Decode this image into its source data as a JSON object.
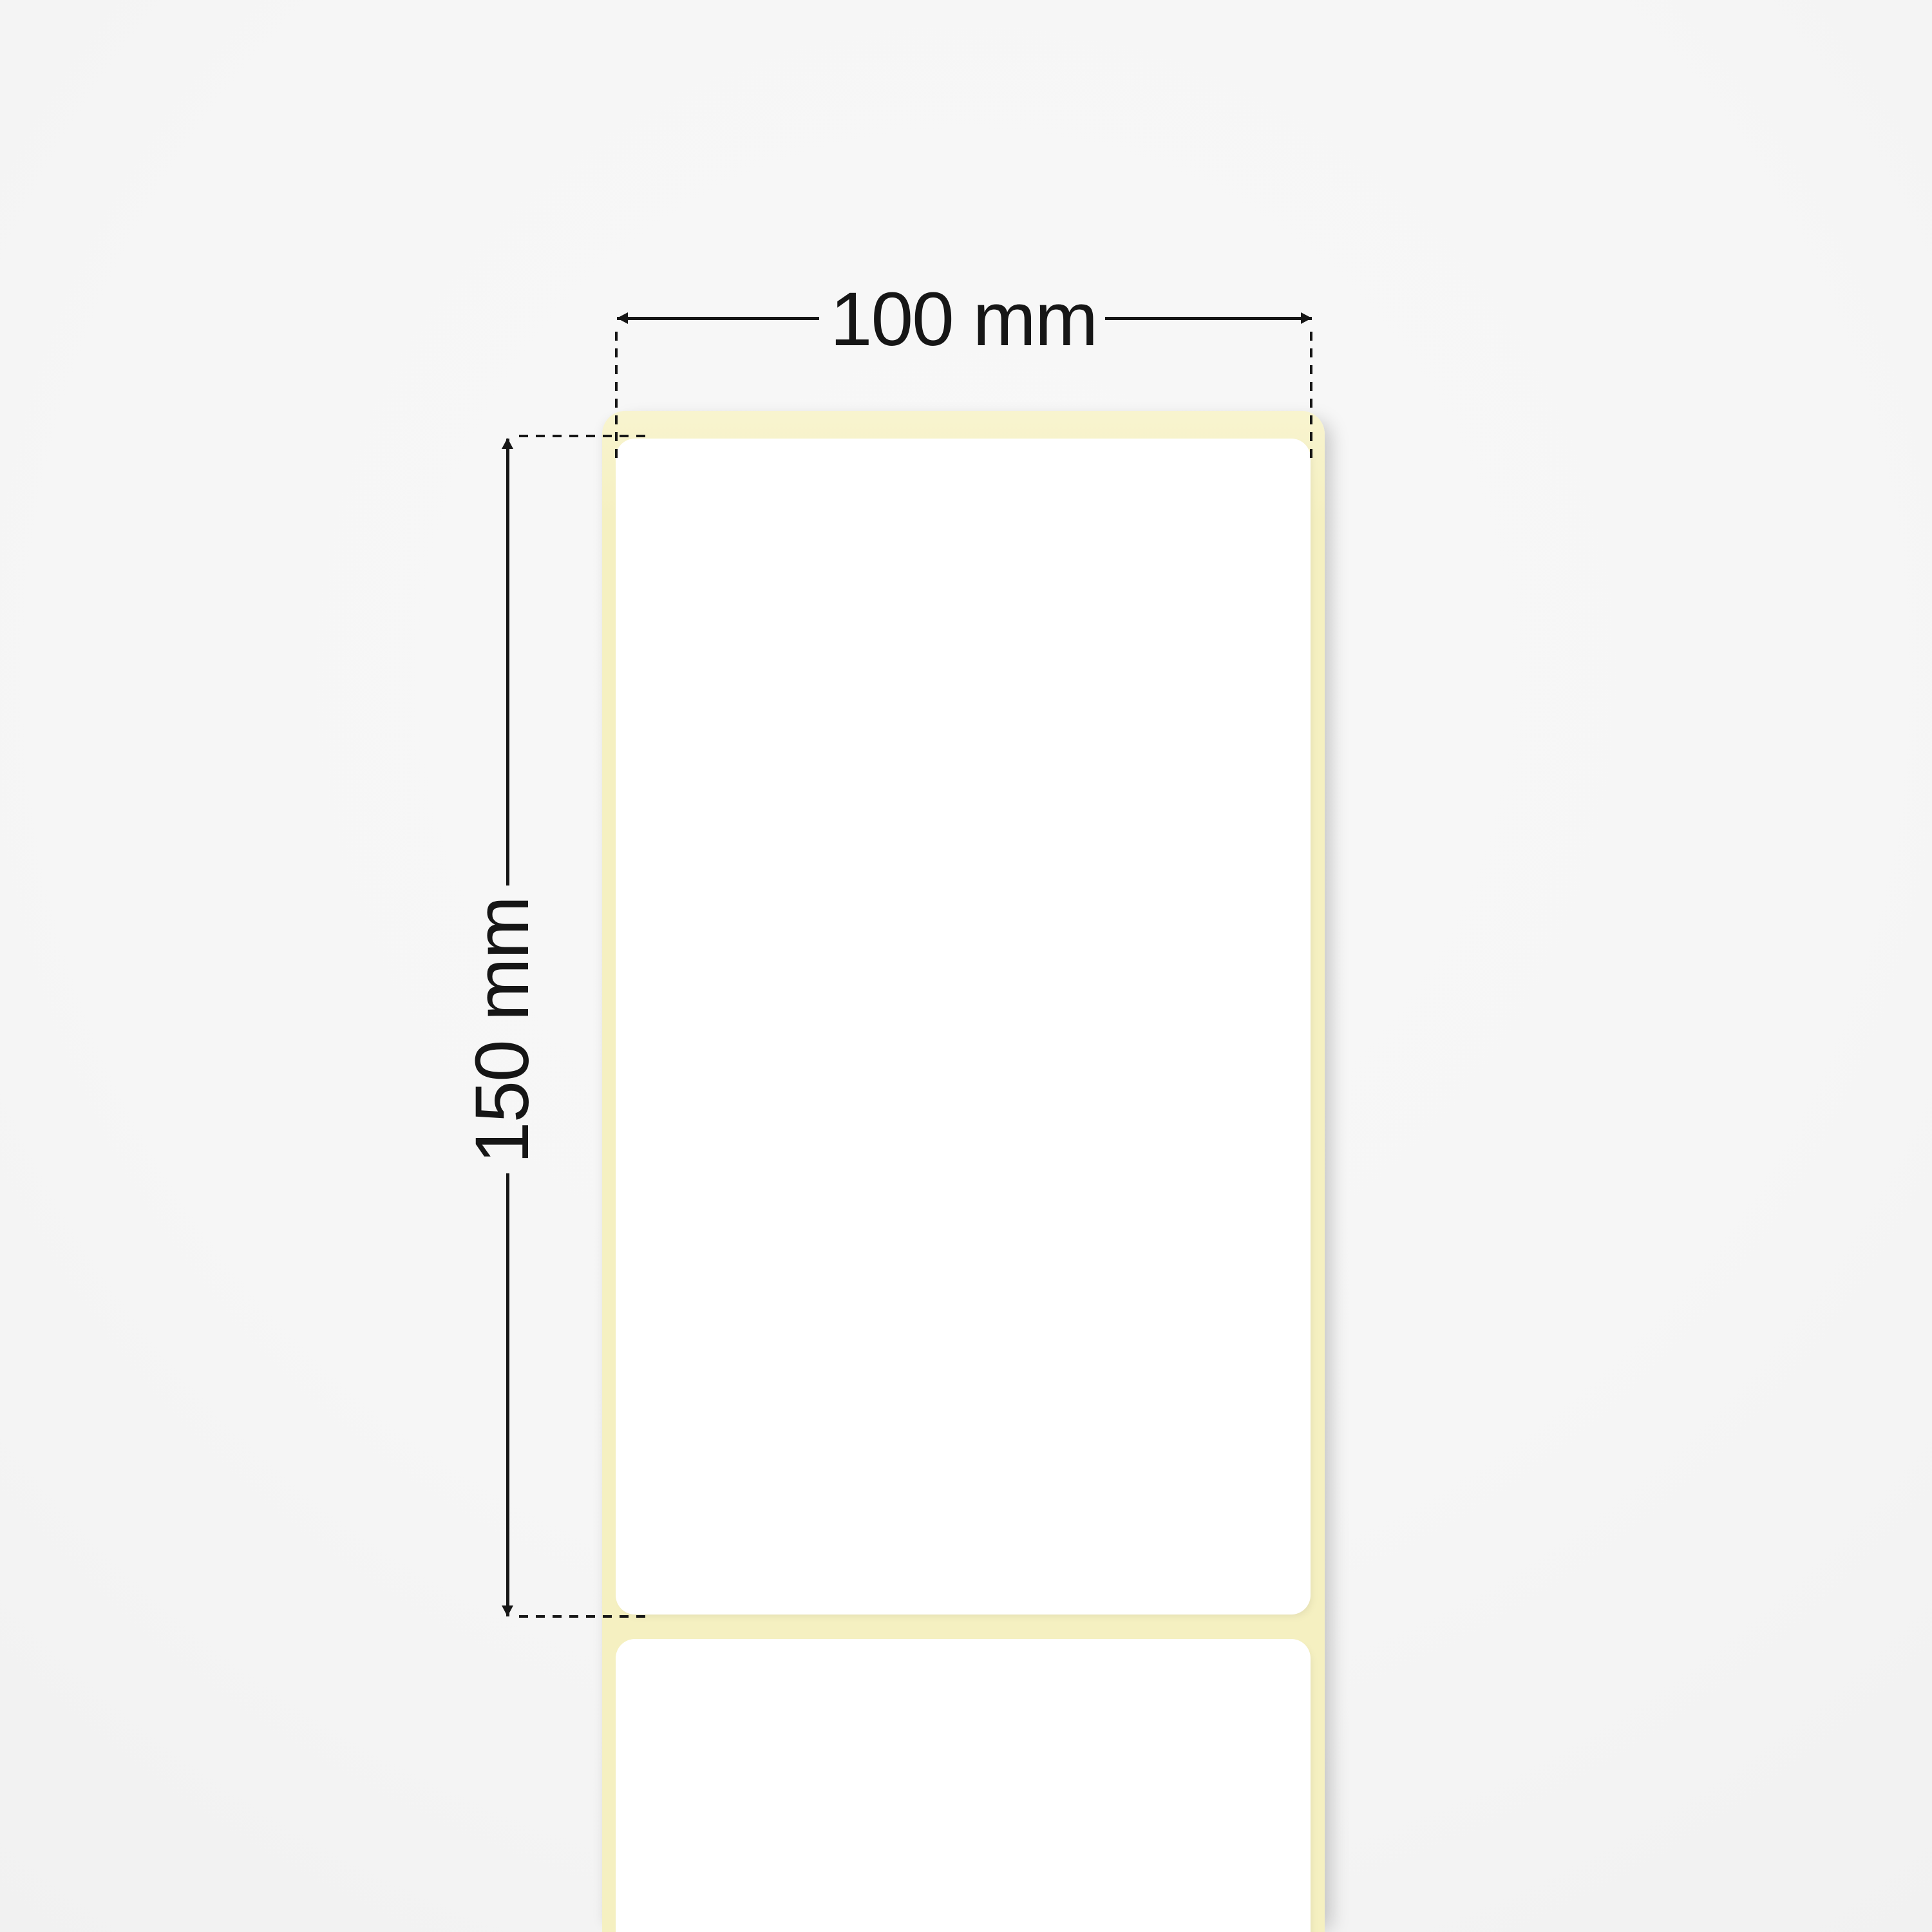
{
  "diagram": {
    "type": "label-roll-dimension-illustration",
    "width_dimension": {
      "label": "100 mm",
      "orientation": "horizontal"
    },
    "height_dimension": {
      "label": "150 mm",
      "orientation": "vertical"
    },
    "colors": {
      "background": "#f6f6f6",
      "background_edge": "#f1f1f1",
      "liner": "#f5f0c1",
      "liner_highlight": "#f8f4cf",
      "label_face": "#ffffff",
      "dimension_ink": "#161616"
    }
  }
}
